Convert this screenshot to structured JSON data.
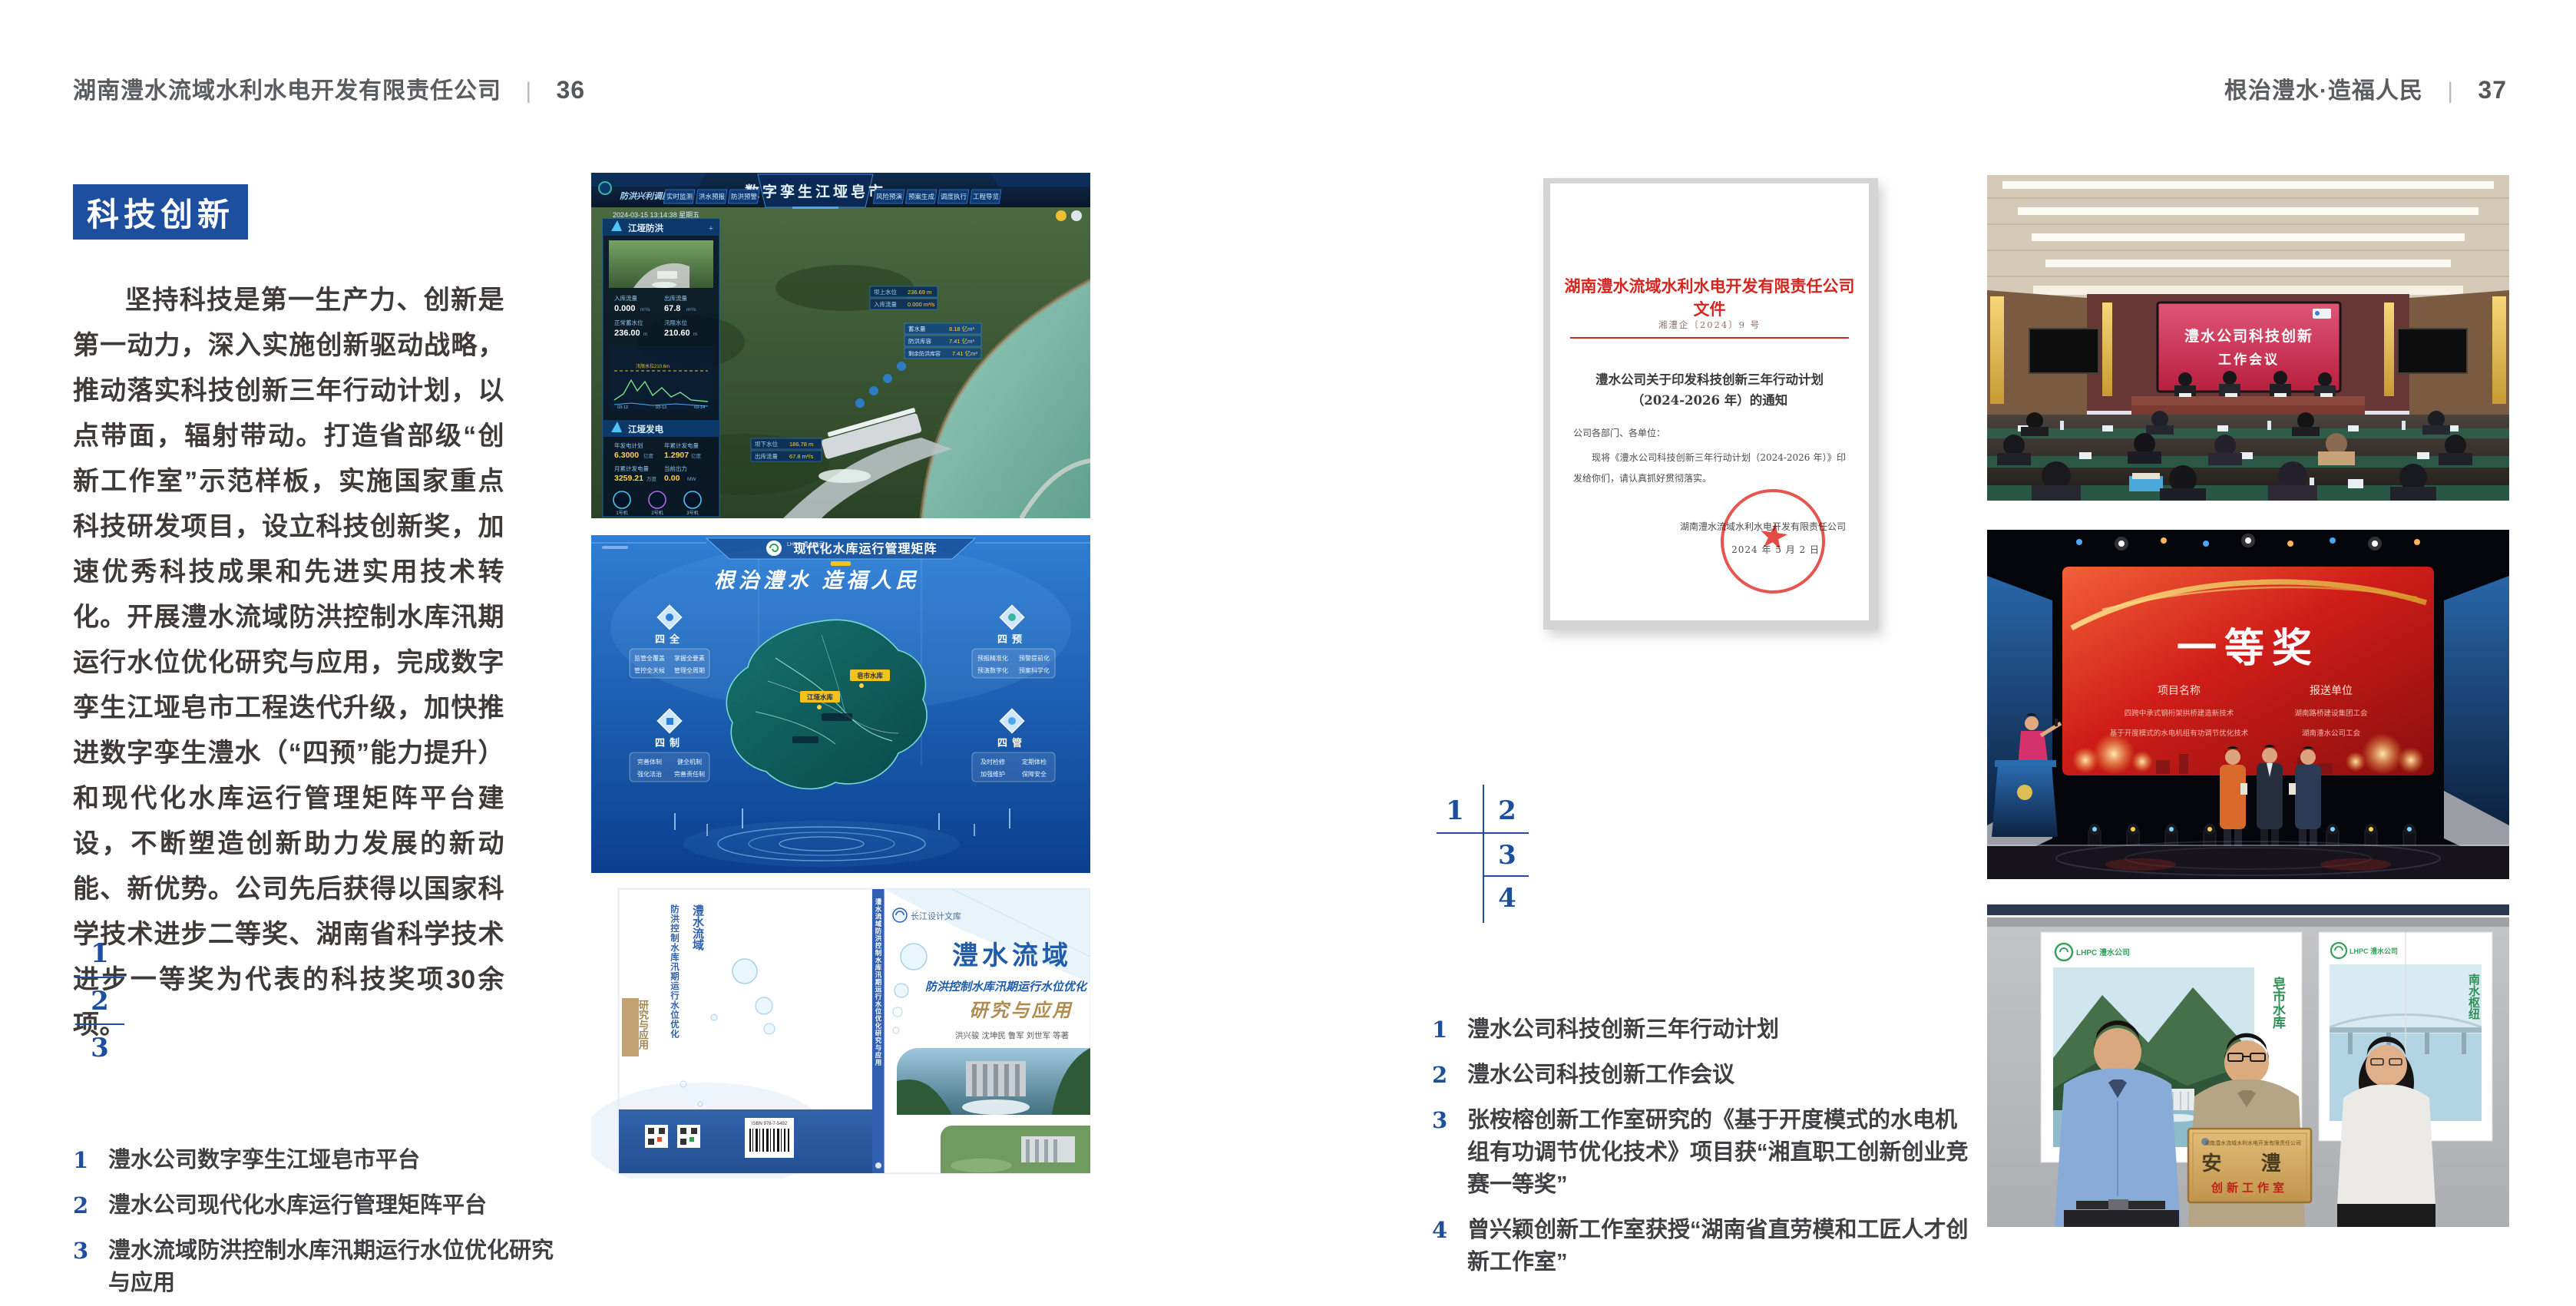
{
  "colors": {
    "accent_blue": "#1d4f9e",
    "header_gray": "#5b5c5f",
    "doc_red": "#d6251f",
    "meeting_screen_red": "#c92c4e",
    "award_screen_red": "#b81414",
    "matrix_blue": "#0c3f8e",
    "plaque_gold": "#d2ab64"
  },
  "page_left": {
    "header": {
      "company": "湖南澧水流域水利水电开发有限责任公司",
      "divider": "|",
      "page_num": "36"
    },
    "section_title": "科技创新",
    "body": "坚持科技是第一生产力、创新是第一动力，深入实施创新驱动战略，推动落实科技创新三年行动计划，以点带面，辐射带动。打造省部级“创新工作室”示范样板，实施国家重点科技研发项目，设立科技创新奖，加速优秀科技成果和先进实用技术转化。开展澧水流域防洪控制水库汛期运行水位优化研究与应用，完成数字孪生江垭皂市工程迭代升级，加快推进数字孪生澧水（“四预”能力提升）和现代化水库运行管理矩阵平台建设，不断塑造创新助力发展的新动能、新优势。公司先后获得以国家科学技术进步二等奖、湖南省科学技术进步一等奖为代表的科技奖项30余项。",
    "figure_index": [
      "1",
      "2",
      "3"
    ],
    "captions": [
      {
        "num": "1",
        "text": "澧水公司数字孪生江垭皂市平台"
      },
      {
        "num": "2",
        "text": "澧水公司现代化水库运行管理矩阵平台"
      },
      {
        "num": "3",
        "text": "澧水流域防洪控制水库汛期运行水位优化研究与应用"
      }
    ]
  },
  "page_right": {
    "header": {
      "slogan": "根治澧水·造福人民",
      "divider": "|",
      "page_num": "37"
    },
    "figure_index": [
      "1",
      "2",
      "3",
      "4"
    ],
    "captions": [
      {
        "num": "1",
        "text": "澧水公司科技创新三年行动计划"
      },
      {
        "num": "2",
        "text": "澧水公司科技创新工作会议"
      },
      {
        "num": "3",
        "text": "张桉榕创新工作室研究的《基于开度模式的水电机组有功调节优化技术》项目获“湘直职工创新创业竞赛一等奖”"
      },
      {
        "num": "4",
        "text": "曾兴颖创新工作室获授“湖南省直劳模和工匠人才创新工作室”"
      }
    ]
  },
  "figures": {
    "digital_twin": {
      "title": "数字孪生江垭皂市",
      "module": "防洪兴利调度",
      "tabs_left": [
        "实时监测",
        "洪水预报",
        "防洪预警"
      ],
      "tabs_right": [
        "风险预演",
        "预案生成",
        "调度执行",
        "工程导览"
      ],
      "timestamp": "2024-03-15 13:14:38 星期五",
      "panel1_title": "江垭防洪",
      "stats1": [
        {
          "label": "入库流量",
          "value": "0.000",
          "unit": "m³/s"
        },
        {
          "label": "出库流量",
          "value": "67.8",
          "unit": "m³/s"
        },
        {
          "label": "正常蓄水位",
          "value": "236.00",
          "unit": "m"
        },
        {
          "label": "汛限水位",
          "value": "210.60",
          "unit": "m"
        }
      ],
      "chart_note": "汛限水位210.6m",
      "chart_dates": [
        "03-12",
        "03-13",
        "03-14"
      ],
      "panel2_title": "江垭发电",
      "stats2": [
        {
          "label": "年发电计划",
          "value": "6.3000",
          "unit": "亿度"
        },
        {
          "label": "年累计发电量",
          "value": "1.2907",
          "unit": "亿度"
        },
        {
          "label": "月累计发电量",
          "value": "3259.21",
          "unit": "万度"
        },
        {
          "label": "当前出力",
          "value": "0.00",
          "unit": "MW"
        }
      ],
      "units": [
        "1号机",
        "2号机",
        "3号机"
      ],
      "chips_left": [
        {
          "label": "坝上水位",
          "value": "236.69 m"
        },
        {
          "label": "入库流量",
          "value": "0.000 m³/s"
        }
      ],
      "chips_mid": [
        {
          "label": "坝下水位",
          "value": "186.78 m"
        },
        {
          "label": "出库流量",
          "value": "67.8 m³/s"
        }
      ],
      "chips_right": [
        {
          "label": "蓄水量",
          "value": "8.18 亿m³"
        },
        {
          "label": "防洪库容",
          "value": "7.41 亿m³"
        },
        {
          "label": "剩余防洪库容",
          "value": "7.41 亿m³"
        }
      ]
    },
    "matrix": {
      "brand": "LHPC 澧水公司",
      "title": "现代化水库运行管理矩阵",
      "slogan": "根治澧水 造福人民",
      "groups": [
        {
          "name": "四全",
          "items": [
            "监管全覆盖",
            "掌握全要素",
            "管控全天候",
            "管理全周期"
          ]
        },
        {
          "name": "四制",
          "items": [
            "完善体制",
            "健全机制",
            "强化法治",
            "完善责任制"
          ]
        },
        {
          "name": "四预",
          "items": [
            "预报精准化",
            "预警提前化",
            "预演数字化",
            "预案科学化"
          ]
        },
        {
          "name": "四管",
          "items": [
            "及时检修",
            "定期体检",
            "加强维护",
            "保障安全"
          ]
        }
      ],
      "labels": [
        "皂市水库",
        "江垭水库"
      ]
    },
    "book": {
      "publisher": "长江设计文库",
      "title": "澧水流域",
      "subtitle": "防洪控制水库汛期运行水位优化",
      "series": "研究与应用",
      "authors": "洪兴骏 沈坤民 鲁军 刘世军 等著",
      "spine": "澧水流域防洪控制水库汛期运行水位优化研究与应用",
      "isbn": "ISBN 978-7-5492"
    },
    "meeting": {
      "line1": "澧水公司科技创新",
      "line2": "工作会议"
    },
    "award": {
      "title": "一等奖",
      "col1": "项目名称",
      "col2": "报送单位",
      "rows": [
        {
          "project": "四跨中承式钢桁架拱桥建造新技术",
          "unit": "湖南路桥建设集团工会"
        },
        {
          "project": "基于开度模式的水电机组有功调节优化技术",
          "unit": "湖南澧水公司工会"
        }
      ]
    },
    "plaque": {
      "brand": "LHPC 澧水公司",
      "org": "湖南澧水流域水利水电开发有限责任公司",
      "name": "安 澧",
      "sub": "创新工作室",
      "poster_left": "皂市水库",
      "poster_right": "南水枢纽"
    },
    "doc": {
      "header": "湖南澧水流域水利水电开发有限责任公司文件",
      "number": "湘澧企〔2024〕9 号",
      "title1": "澧水公司关于印发科技创新三年行动计划",
      "title2": "（2024-2026 年）的通知",
      "salute": "公司各部门、各单位：",
      "body": "现将《澧水公司科技创新三年行动计划（2024-2026 年）》印发给你们，请认真抓好贯彻落实。",
      "signer": "湖南澧水流域水利水电开发有限责任公司",
      "date": "2024 年 5 月 2 日"
    }
  }
}
